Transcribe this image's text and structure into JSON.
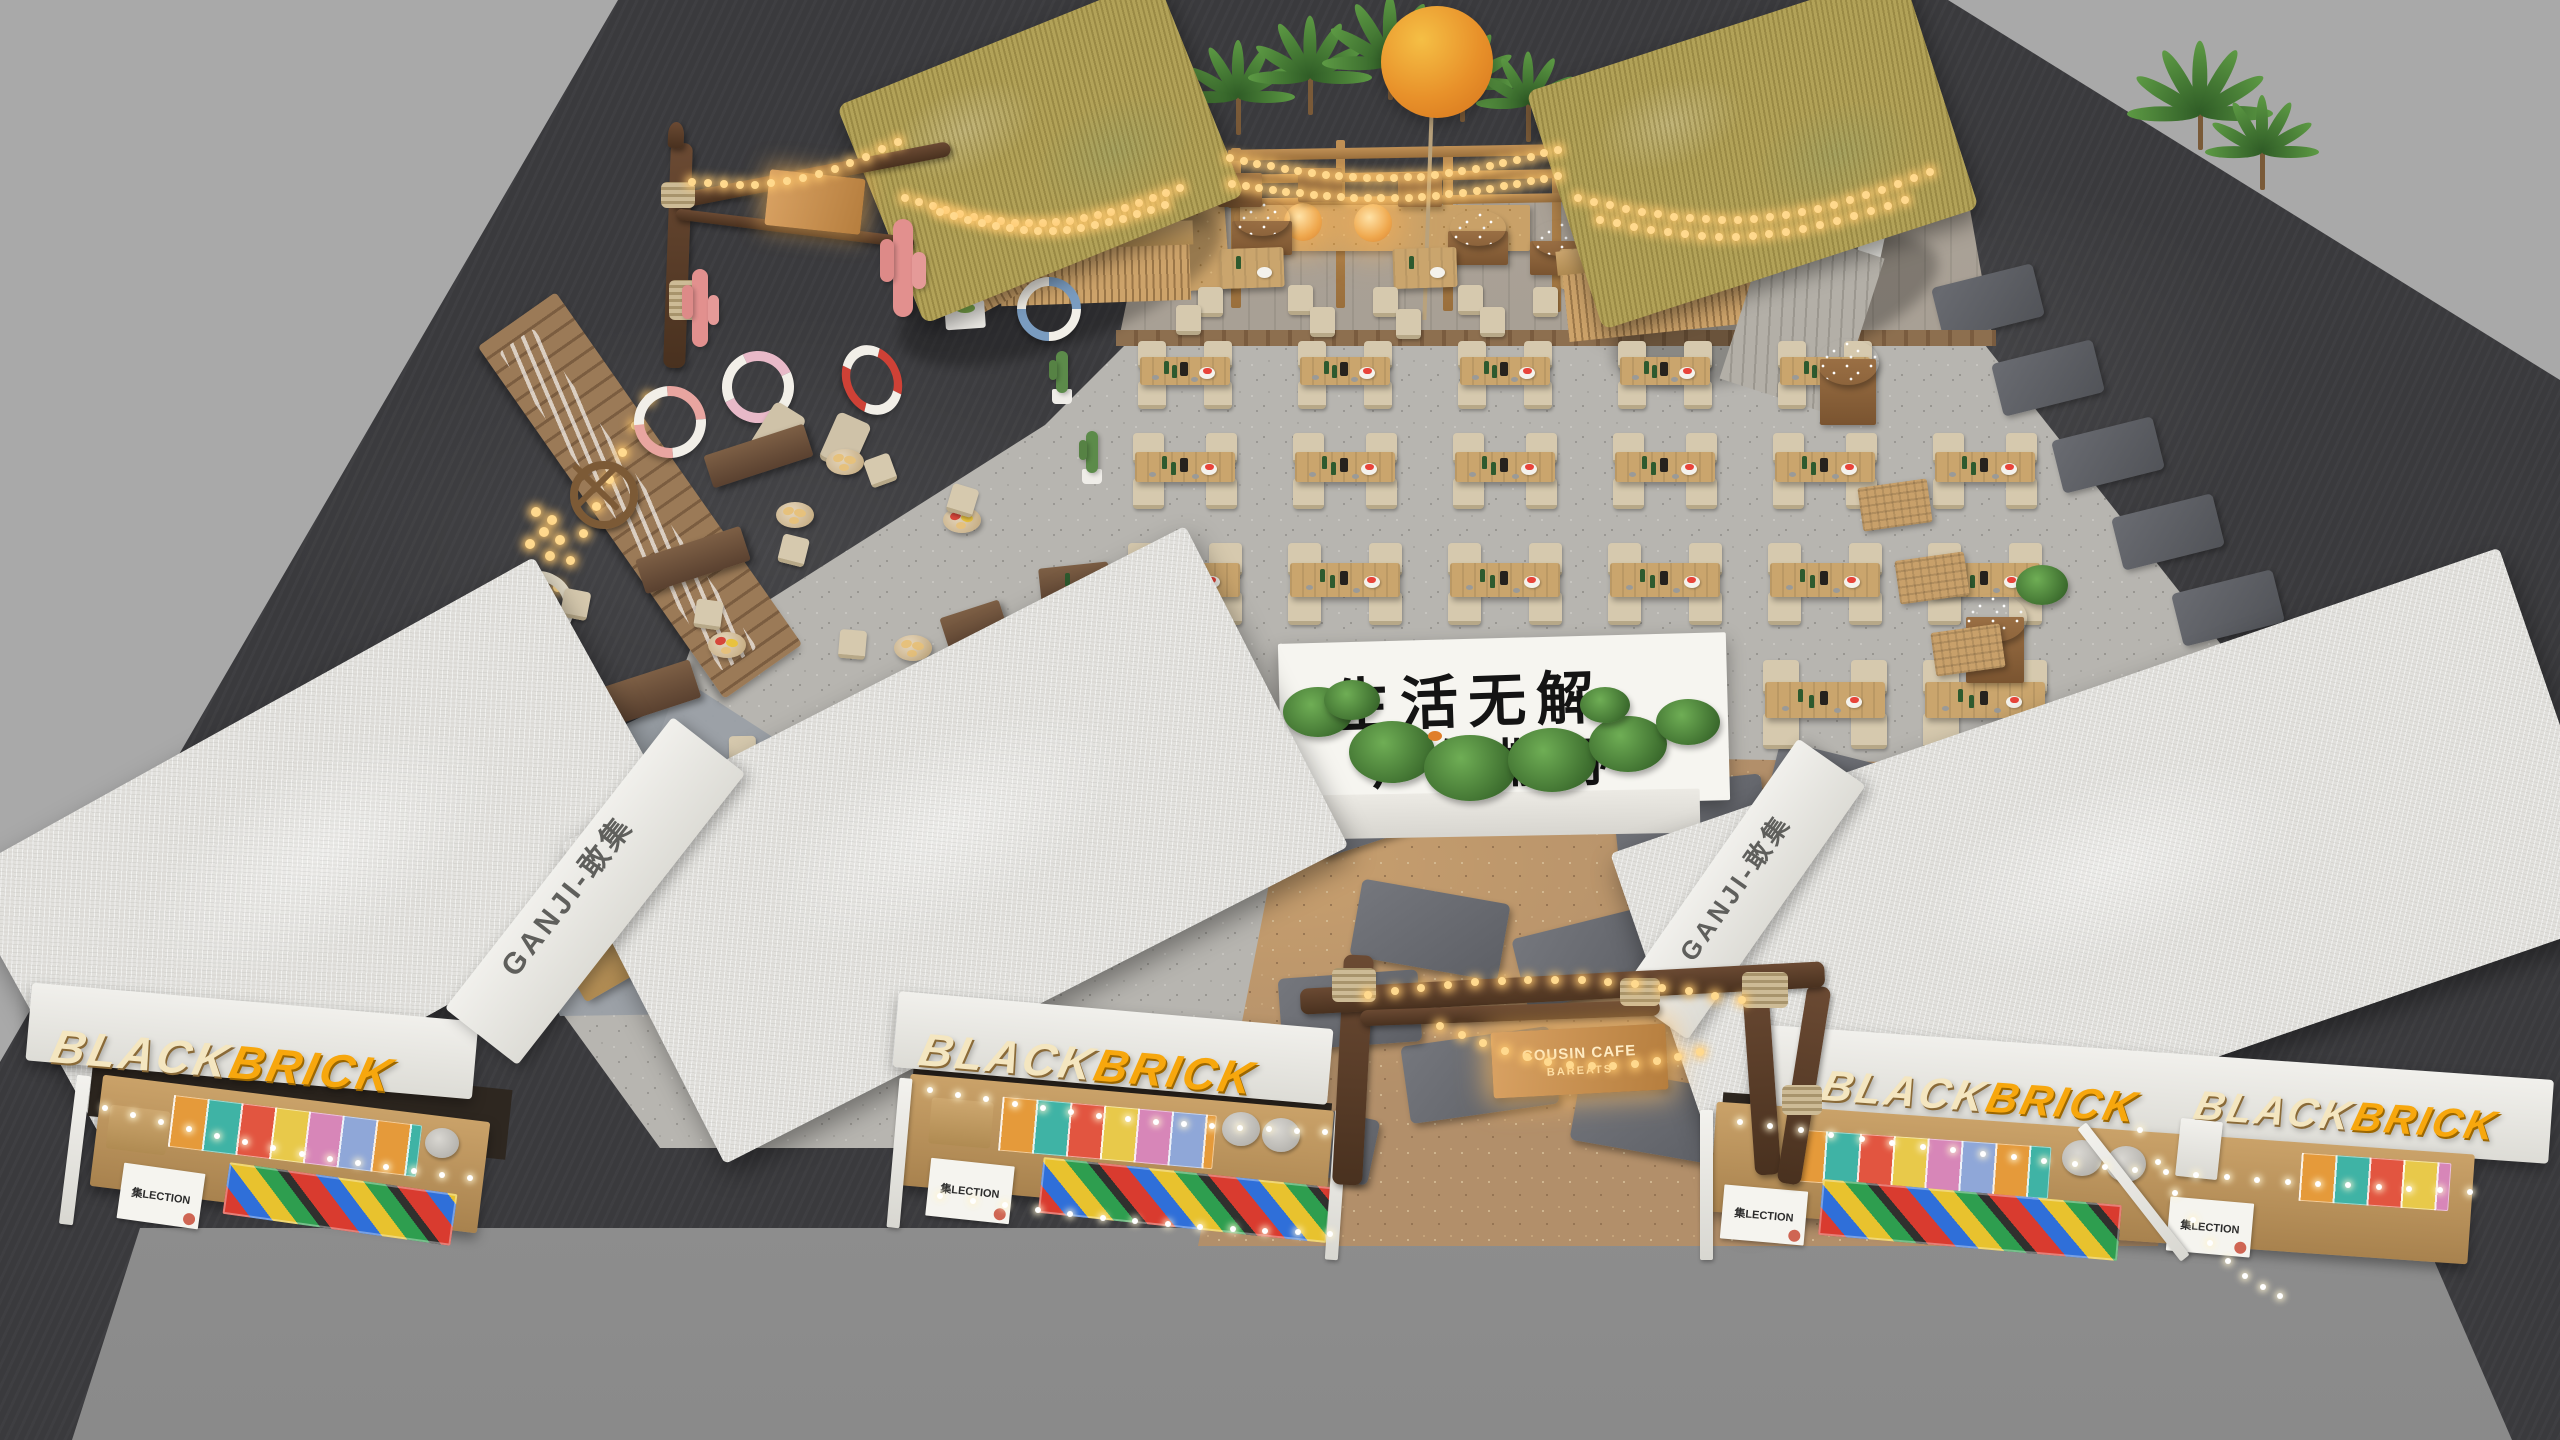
{
  "scene": {
    "description": "Aerial 3D render of an outdoor beach-style market plaza with tiki bar huts, string-lit dining area, gravel plaza and white market kiosks",
    "environment": {
      "outer_floor": "#a9a9a9",
      "dark_floor": "#3a3a3d",
      "gravel": "#b7b5b0",
      "warm_pebbles": "#b28f6a",
      "concrete_apron": "#9a9a9a"
    },
    "counts": {
      "kiosks": 3,
      "tiki_huts": 2,
      "blackbrick_signs": 4,
      "dining_tables": 21,
      "lifebuoys": 5,
      "pink_cacti": 2
    }
  },
  "branding": {
    "sign_black": "BLACK",
    "sign_brick": "BRICK",
    "roof_text": "GANJI-敢集",
    "collection_poster": "集LECTION"
  },
  "signs": {
    "slogan_line1": "生活无解",
    "slogan_line2": "户外撒野",
    "entrance_line1": "COUSIN CAFE",
    "entrance_line2": "BAREATS"
  },
  "palette": {
    "sign_cream": "#f4e6c0",
    "sign_amber": "#f7a70d",
    "thatch": "#b2a258",
    "wood": "#caa56d",
    "driftwood": "#5d4430",
    "chair_beige": "#d6c9ae",
    "cactus_pink": "#e2908e",
    "balloon_orange": "#e8912a",
    "watermelon_red": "#e8443a",
    "teal_accent": "#3bb3a8",
    "lifebuoy_red": "#cf4136"
  }
}
